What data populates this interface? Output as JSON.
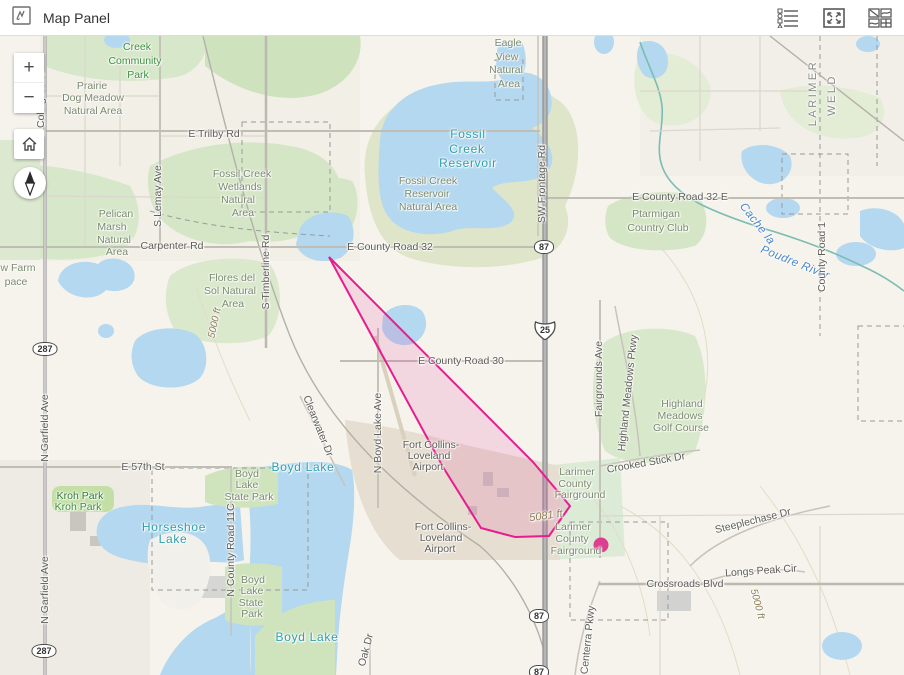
{
  "header": {
    "title": "Map Panel",
    "icons": {
      "panel": "map-sketch-icon",
      "legend": "legend-icon",
      "expand": "expand-icon",
      "basemap": "basemap-gallery-icon"
    }
  },
  "controls": {
    "zoom_in": "+",
    "zoom_out": "−",
    "home": "home-icon",
    "compass": "compass-icon"
  },
  "colors": {
    "polygon_stroke": "#e61c8f",
    "polygon_fill": "rgba(230,28,143,0.13)",
    "marker": "#de3d90",
    "water": "#b3d8ef",
    "water_label": "#2e9fae",
    "header_bg": "#ffffff"
  },
  "map": {
    "polygon_points": [
      [
        329,
        221
      ],
      [
        533,
        426
      ],
      [
        570,
        470
      ],
      [
        549,
        500
      ],
      [
        515,
        501
      ],
      [
        481,
        492
      ],
      [
        443,
        431
      ]
    ],
    "marker": {
      "x": 601,
      "y": 509,
      "r": 7.5
    },
    "shields": [
      {
        "type": "us",
        "text": "287",
        "x": 45,
        "y": 312
      },
      {
        "type": "us",
        "text": "287",
        "x": 44,
        "y": 614
      },
      {
        "type": "us",
        "text": "87",
        "x": 544,
        "y": 210
      },
      {
        "type": "us",
        "text": "87",
        "x": 539,
        "y": 579
      },
      {
        "type": "us",
        "text": "87",
        "x": 539,
        "y": 635
      },
      {
        "type": "interstate",
        "text": "25",
        "x": 545,
        "y": 296
      }
    ],
    "labels": [
      {
        "t": "Creek",
        "x": 137,
        "y": 11,
        "c": "park"
      },
      {
        "t": "Community",
        "x": 135,
        "y": 25,
        "c": "park"
      },
      {
        "t": "Park",
        "x": 138,
        "y": 39,
        "c": "park"
      },
      {
        "t": "Prairie",
        "x": 92,
        "y": 50,
        "c": "area"
      },
      {
        "t": "Dog Meadow",
        "x": 93,
        "y": 62,
        "c": "area"
      },
      {
        "t": "Natural Area",
        "x": 93,
        "y": 75,
        "c": "area"
      },
      {
        "t": "E Trilby Rd",
        "x": 214,
        "y": 98,
        "c": "road"
      },
      {
        "t": "S Lemay Ave",
        "x": 158,
        "y": 160,
        "c": "road",
        "r": -90
      },
      {
        "t": "S College Ave",
        "x": 41,
        "y": 69,
        "c": "road",
        "r": -90
      },
      {
        "t": "Fossil Creek",
        "x": 242,
        "y": 138,
        "c": "area"
      },
      {
        "t": "Wetlands",
        "x": 240,
        "y": 151,
        "c": "area"
      },
      {
        "t": "Natural",
        "x": 238,
        "y": 164,
        "c": "area"
      },
      {
        "t": "Area",
        "x": 243,
        "y": 177,
        "c": "area"
      },
      {
        "t": "Pelican",
        "x": 116,
        "y": 178,
        "c": "area"
      },
      {
        "t": "Marsh",
        "x": 112,
        "y": 191,
        "c": "area"
      },
      {
        "t": "Natural",
        "x": 114,
        "y": 204,
        "c": "area"
      },
      {
        "t": "Area",
        "x": 117,
        "y": 216,
        "c": "area"
      },
      {
        "t": "Carpenter Rd",
        "x": 172,
        "y": 210,
        "c": "road"
      },
      {
        "t": "w Farm",
        "x": 18,
        "y": 232,
        "c": "area"
      },
      {
        "t": "pace",
        "x": 16,
        "y": 246,
        "c": "area"
      },
      {
        "t": "Eagle",
        "x": 508,
        "y": 7,
        "c": "area"
      },
      {
        "t": "View",
        "x": 507,
        "y": 21,
        "c": "area"
      },
      {
        "t": "Natural",
        "x": 506,
        "y": 34,
        "c": "area"
      },
      {
        "t": "Area",
        "x": 509,
        "y": 48,
        "c": "area"
      },
      {
        "t": "Fossil",
        "x": 468,
        "y": 98,
        "c": "water"
      },
      {
        "t": "Creek",
        "x": 467,
        "y": 113,
        "c": "water"
      },
      {
        "t": "Reservoir",
        "x": 468,
        "y": 127,
        "c": "water"
      },
      {
        "t": "SW Frontage Rd",
        "x": 542,
        "y": 148,
        "c": "road",
        "r": -90
      },
      {
        "t": "Fossil Creek",
        "x": 428,
        "y": 145,
        "c": "area"
      },
      {
        "t": "Reservoir",
        "x": 427,
        "y": 158,
        "c": "area"
      },
      {
        "t": "Natural Area",
        "x": 428,
        "y": 171,
        "c": "area"
      },
      {
        "t": "E County Road 32",
        "x": 390,
        "y": 211,
        "c": "road"
      },
      {
        "t": "E County Road 32 E",
        "x": 680,
        "y": 161,
        "c": "road"
      },
      {
        "t": "Ptarmigan",
        "x": 656,
        "y": 178,
        "c": "area"
      },
      {
        "t": "Country Club",
        "x": 658,
        "y": 192,
        "c": "area"
      },
      {
        "t": "LARIMER",
        "x": 813,
        "y": 57,
        "c": "county",
        "r": -90
      },
      {
        "t": "WELD",
        "x": 832,
        "y": 59,
        "c": "county",
        "r": -90
      },
      {
        "t": "Cache la",
        "x": 757,
        "y": 188,
        "c": "river",
        "r": 52
      },
      {
        "t": "Poudre River",
        "x": 795,
        "y": 227,
        "c": "river",
        "r": 22
      },
      {
        "t": "County Road 1",
        "x": 822,
        "y": 221,
        "c": "road",
        "r": -90
      },
      {
        "t": "E County Road 30",
        "x": 461,
        "y": 325,
        "c": "road"
      },
      {
        "t": "S Timberline Rd",
        "x": 266,
        "y": 236,
        "c": "road",
        "r": -90
      },
      {
        "t": "Flores del",
        "x": 232,
        "y": 242,
        "c": "area"
      },
      {
        "t": "Sol Natural",
        "x": 230,
        "y": 255,
        "c": "area"
      },
      {
        "t": "Area",
        "x": 233,
        "y": 268,
        "c": "area"
      },
      {
        "t": "5000 ft",
        "x": 215,
        "y": 287,
        "c": "contour",
        "r": -78
      },
      {
        "t": "N Boyd Lake Ave",
        "x": 378,
        "y": 397,
        "c": "road",
        "r": -90
      },
      {
        "t": "Clearwater Dr",
        "x": 318,
        "y": 390,
        "c": "road",
        "r": 68
      },
      {
        "t": "Fort Collins-",
        "x": 431,
        "y": 409,
        "c": "road"
      },
      {
        "t": "Loveland",
        "x": 429,
        "y": 420,
        "c": "road"
      },
      {
        "t": "Airport",
        "x": 428,
        "y": 431,
        "c": "road"
      },
      {
        "t": "Fairgrounds Ave",
        "x": 599,
        "y": 343,
        "c": "road",
        "r": -90
      },
      {
        "t": "Highland Meadows Pkwy",
        "x": 628,
        "y": 357,
        "c": "road",
        "r": -84
      },
      {
        "t": "Highland",
        "x": 682,
        "y": 368,
        "c": "area"
      },
      {
        "t": "Meadows",
        "x": 680,
        "y": 380,
        "c": "area"
      },
      {
        "t": "Golf Course",
        "x": 681,
        "y": 392,
        "c": "area"
      },
      {
        "t": "Crooked Stick Dr",
        "x": 646,
        "y": 427,
        "c": "road",
        "r": -10
      },
      {
        "t": "Larimer",
        "x": 577,
        "y": 436,
        "c": "area"
      },
      {
        "t": "County",
        "x": 575,
        "y": 448,
        "c": "area"
      },
      {
        "t": "Fairground",
        "x": 580,
        "y": 459,
        "c": "area"
      },
      {
        "t": "5081 ft",
        "x": 546,
        "y": 480,
        "c": "contour",
        "r": -8,
        "s": 11
      },
      {
        "t": "Larimer",
        "x": 573,
        "y": 491,
        "c": "area"
      },
      {
        "t": "County",
        "x": 572,
        "y": 503,
        "c": "area"
      },
      {
        "t": "Fairground",
        "x": 576,
        "y": 515,
        "c": "area"
      },
      {
        "t": "N Garfield Ave",
        "x": 45,
        "y": 392,
        "c": "road",
        "r": -90
      },
      {
        "t": "E 57th St",
        "x": 143,
        "y": 431,
        "c": "road"
      },
      {
        "t": "Boyd Lake",
        "x": 303,
        "y": 431,
        "c": "water"
      },
      {
        "t": "Boyd",
        "x": 247,
        "y": 438,
        "c": "area"
      },
      {
        "t": "Lake",
        "x": 247,
        "y": 449,
        "c": "area"
      },
      {
        "t": "State Park",
        "x": 249,
        "y": 461,
        "c": "area"
      },
      {
        "t": "Kroh Park",
        "x": 80,
        "y": 460,
        "c": "park2"
      },
      {
        "t": "Kroh Park",
        "x": 78,
        "y": 471,
        "c": "park"
      },
      {
        "t": "Horseshoe",
        "x": 174,
        "y": 491,
        "c": "water"
      },
      {
        "t": "Lake",
        "x": 173,
        "y": 503,
        "c": "water"
      },
      {
        "t": "N County Road 11C",
        "x": 231,
        "y": 514,
        "c": "road",
        "r": -90
      },
      {
        "t": "Boyd",
        "x": 253,
        "y": 544,
        "c": "area"
      },
      {
        "t": "Lake",
        "x": 252,
        "y": 555,
        "c": "area"
      },
      {
        "t": "State",
        "x": 251,
        "y": 567,
        "c": "area"
      },
      {
        "t": "Park",
        "x": 252,
        "y": 578,
        "c": "area"
      },
      {
        "t": "N Garfield Ave",
        "x": 45,
        "y": 554,
        "c": "road",
        "r": -90
      },
      {
        "t": "Fort Collins-",
        "x": 443,
        "y": 491,
        "c": "road"
      },
      {
        "t": "Loveland",
        "x": 441,
        "y": 502,
        "c": "road"
      },
      {
        "t": "Airport",
        "x": 440,
        "y": 513,
        "c": "road"
      },
      {
        "t": "Crossroads Blvd",
        "x": 685,
        "y": 548,
        "c": "road"
      },
      {
        "t": "Steeplechase Dr",
        "x": 753,
        "y": 485,
        "c": "road",
        "r": -14
      },
      {
        "t": "Longs Peak Cir",
        "x": 761,
        "y": 535,
        "c": "road",
        "r": -4
      },
      {
        "t": "5000 ft",
        "x": 757,
        "y": 568,
        "c": "contour",
        "r": 75
      },
      {
        "t": "Centerra Pkwy",
        "x": 588,
        "y": 604,
        "c": "road",
        "r": -84
      },
      {
        "t": "Oak Dr",
        "x": 366,
        "y": 614,
        "c": "road",
        "r": -75
      },
      {
        "t": "Boyd Lake",
        "x": 307,
        "y": 601,
        "c": "water"
      }
    ]
  }
}
